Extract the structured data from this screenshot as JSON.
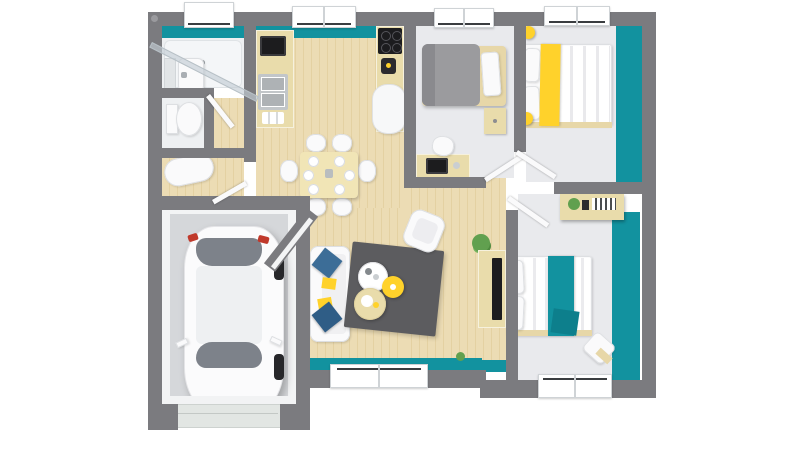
{
  "meta": {
    "type": "3d-top-down-floorplan-render",
    "background": "#ffffff"
  },
  "colors": {
    "wall": "#7b7b7f",
    "wall_light": "#96969a",
    "teal": "#12929f",
    "teal_dark": "#0d7f8c",
    "wood": "#ecdcb4",
    "wood_stripe": "#e4d1a2",
    "tile": "#eef0f2",
    "bedroom_floor": "#e9eaed",
    "garage_floor": "#d5d7da",
    "garage_trim": "#f3f4f5",
    "rug": "#5c5c5f",
    "furn_white": "#fafafb",
    "furn_edge": "#dddfe2",
    "pillow_blue": "#3c6d97",
    "pillow_blue_dark": "#2f5d86",
    "accent_yellow": "#ffd22b",
    "bed_gray": "#9b9b9e",
    "bed_gray_dark": "#8a8a8e",
    "counter": "#e9dcab",
    "appliance_black": "#1c1c1e",
    "glass": "#7d828a",
    "plant_green": "#61a04f",
    "taillight_red": "#c0392b",
    "garage_door": "#e2e6e3"
  },
  "rooms": [
    {
      "name": "bathroom",
      "features": [
        "corner-shower",
        "glass-door",
        "sink",
        "shelf-unit"
      ]
    },
    {
      "name": "wc",
      "features": [
        "toilet"
      ]
    },
    {
      "name": "tub-room",
      "features": [
        "bathtub"
      ]
    },
    {
      "name": "kitchen",
      "features": [
        "microwave",
        "double-sink",
        "dishes",
        "cooktop-4-burners",
        "coffee-maker",
        "fridge"
      ]
    },
    {
      "name": "dining-area",
      "features": [
        "table",
        "6-chairs",
        "6-place-settings"
      ]
    },
    {
      "name": "living-room",
      "features": [
        "sofa",
        "blue-cushions",
        "yellow-cushions",
        "gray-rug",
        "3-coffee-tables",
        "armchair",
        "tv-console",
        "tv",
        "plant"
      ]
    },
    {
      "name": "bedroom-1",
      "features": [
        "single-bed-gray",
        "nightstand",
        "desk",
        "laptop",
        "chair"
      ]
    },
    {
      "name": "bedroom-2",
      "features": [
        "double-bed-yellow-runner",
        "two-yellow-ball-lamps",
        "teal-accent-wall"
      ]
    },
    {
      "name": "bedroom-3",
      "features": [
        "double-bed-teal-runner",
        "desk-shelf",
        "chair",
        "teal-accent-wall"
      ]
    },
    {
      "name": "hallway",
      "features": [
        "open-doors"
      ]
    },
    {
      "name": "garage",
      "features": [
        "white-car",
        "garage-door"
      ]
    }
  ],
  "windows": {
    "top_wall": 4,
    "bottom_wall": 2
  },
  "doors_open": 5
}
